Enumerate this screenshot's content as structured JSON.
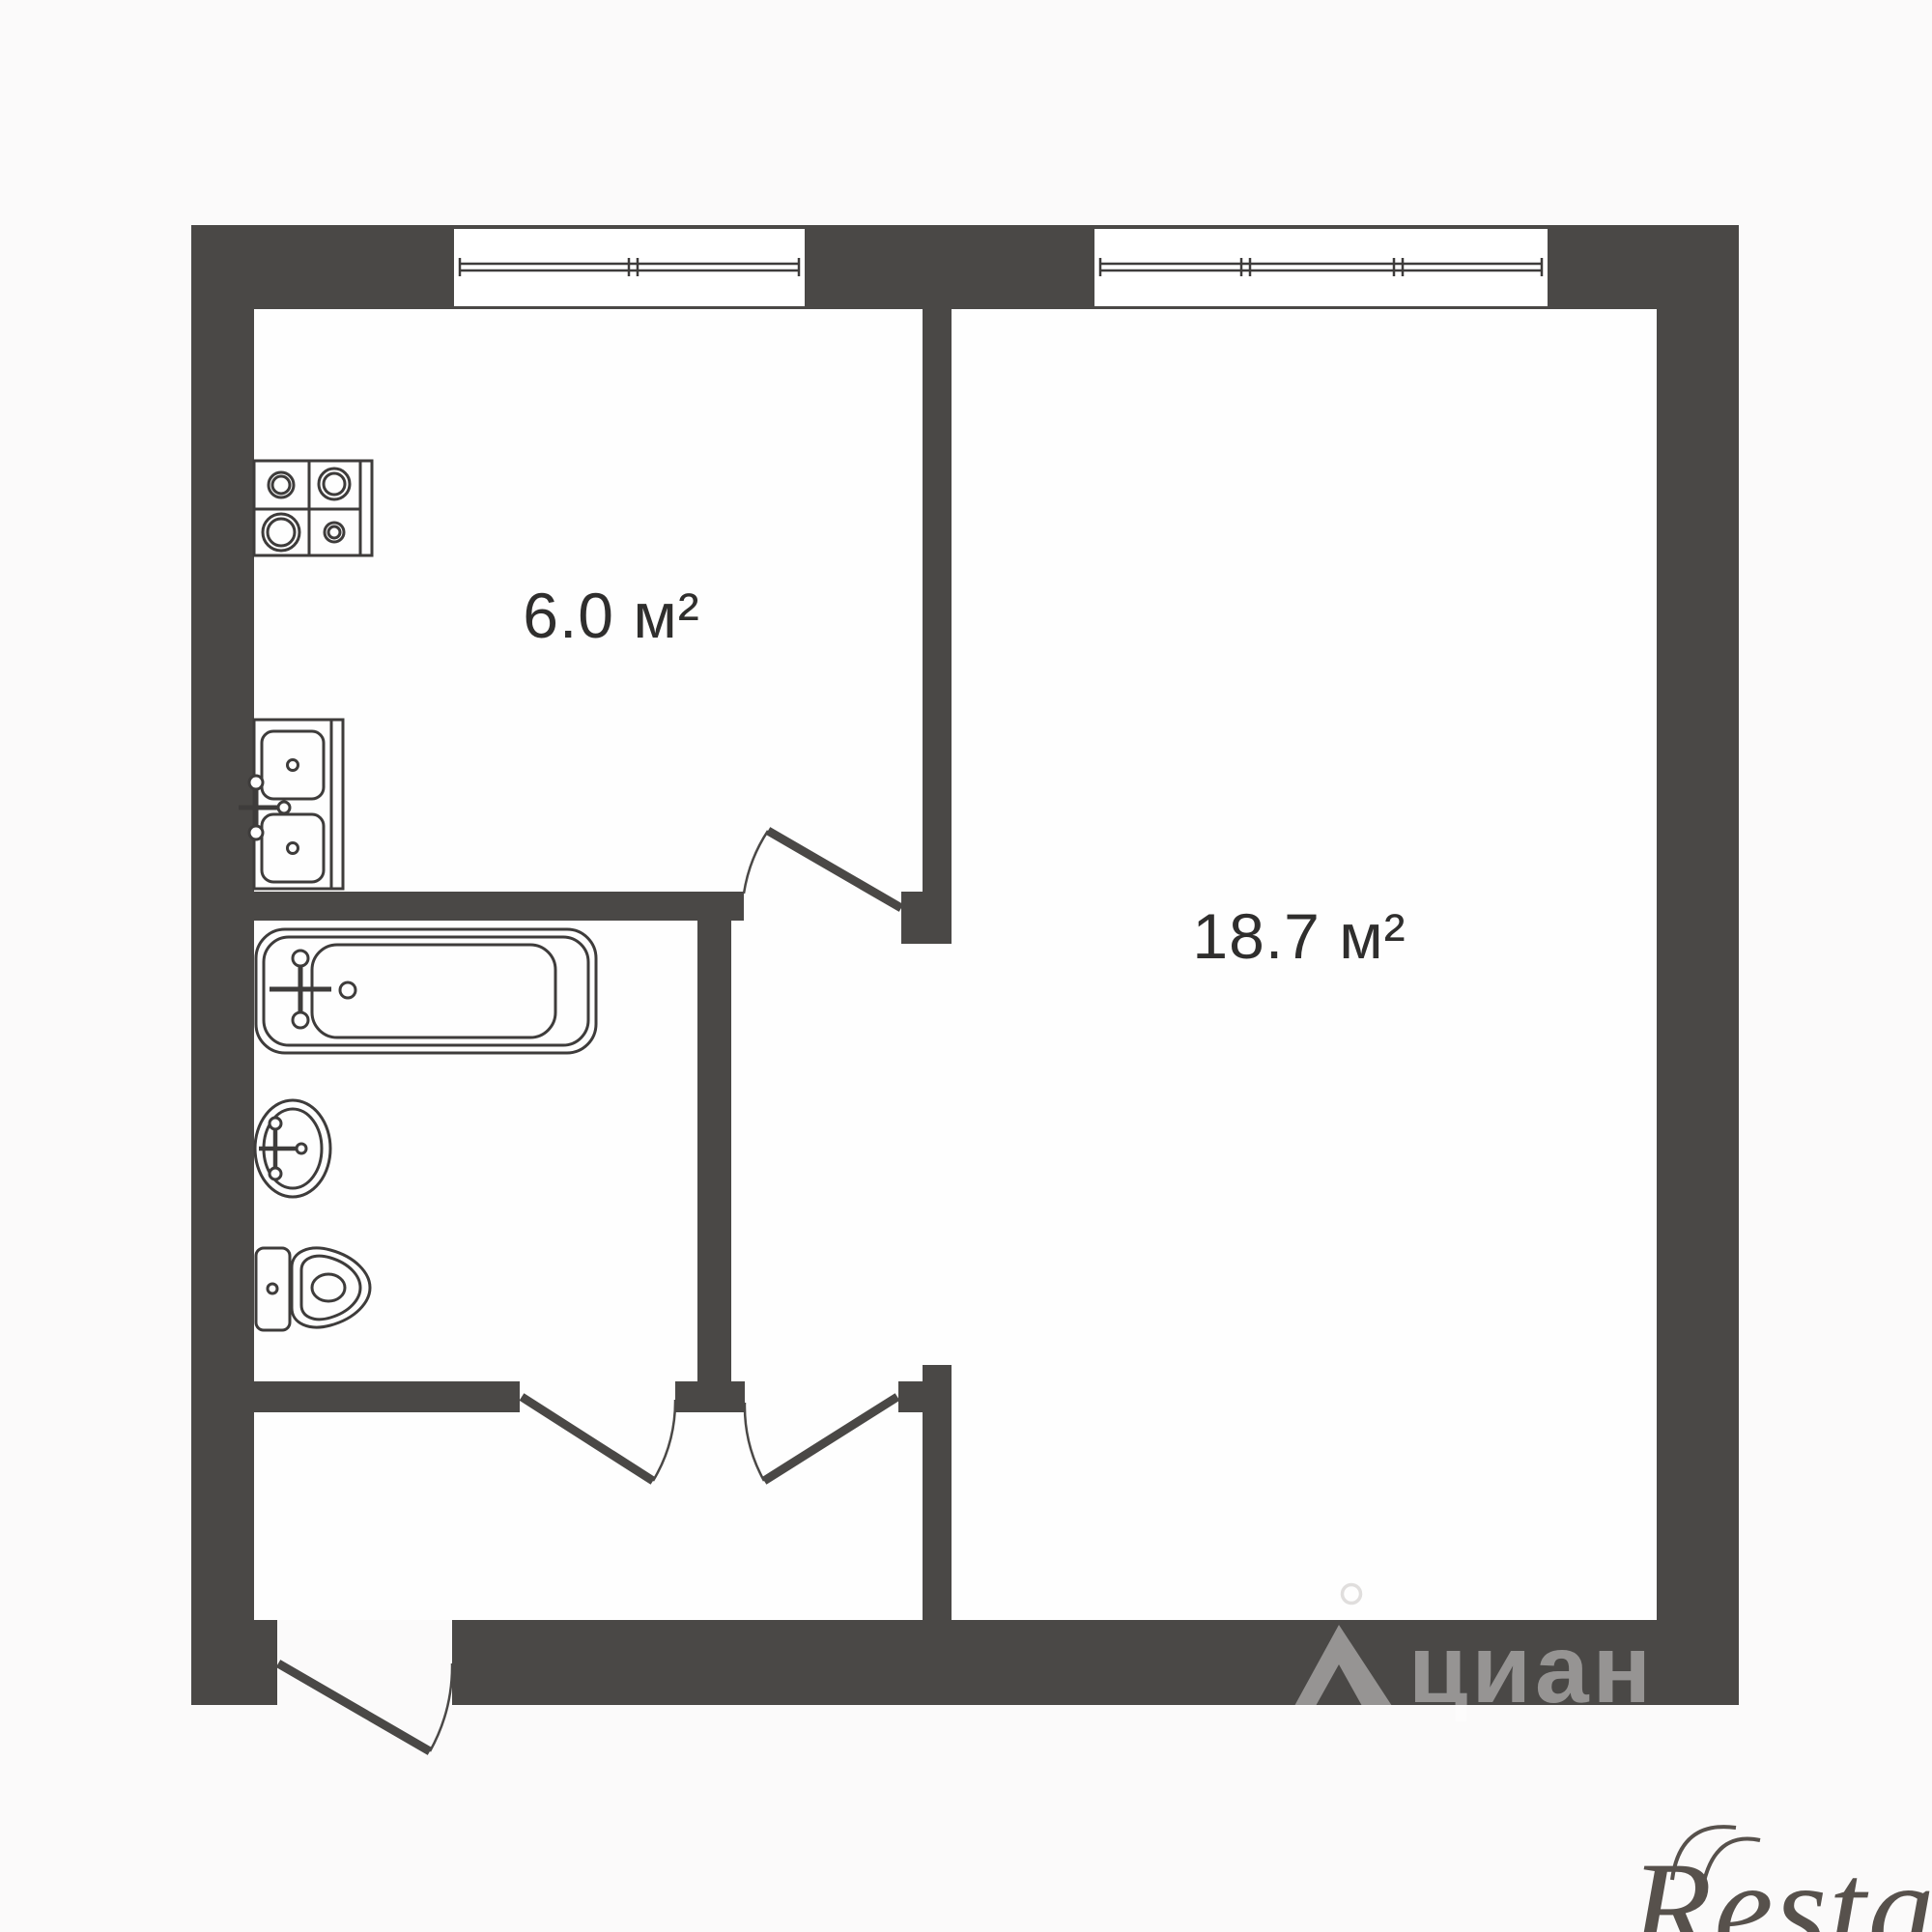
{
  "page": {
    "background": "#fbfafa",
    "floor_color": "#fefefe",
    "kind": "apartment floor plan"
  },
  "plan": {
    "wall_color": "#4a4846",
    "line_color": "#3e3c3b",
    "label_color": "#2f2e2d",
    "rooms": [
      {
        "id": "kitchen",
        "area_label": "6.0 м²"
      },
      {
        "id": "living-room",
        "area_label": "18.7 м²"
      }
    ],
    "fixtures": [
      "stove-icon",
      "kitchen-sink-icon",
      "bathtub-icon",
      "washbasin-icon",
      "toilet-icon"
    ],
    "doors": [
      "kitchen-door",
      "bathroom-door",
      "hall-door",
      "entrance-door"
    ],
    "windows": [
      "kitchen-window",
      "living-room-window"
    ]
  },
  "watermarks": {
    "etagi": {
      "text": "etagi",
      "color": "#ededeb"
    },
    "cian": {
      "text": "циан",
      "color": "rgba(255,255,255,0.42)",
      "logo_ring_color": "#e0dedd"
    },
    "restate": {
      "text": "Restate",
      "color": "#57514c"
    }
  }
}
